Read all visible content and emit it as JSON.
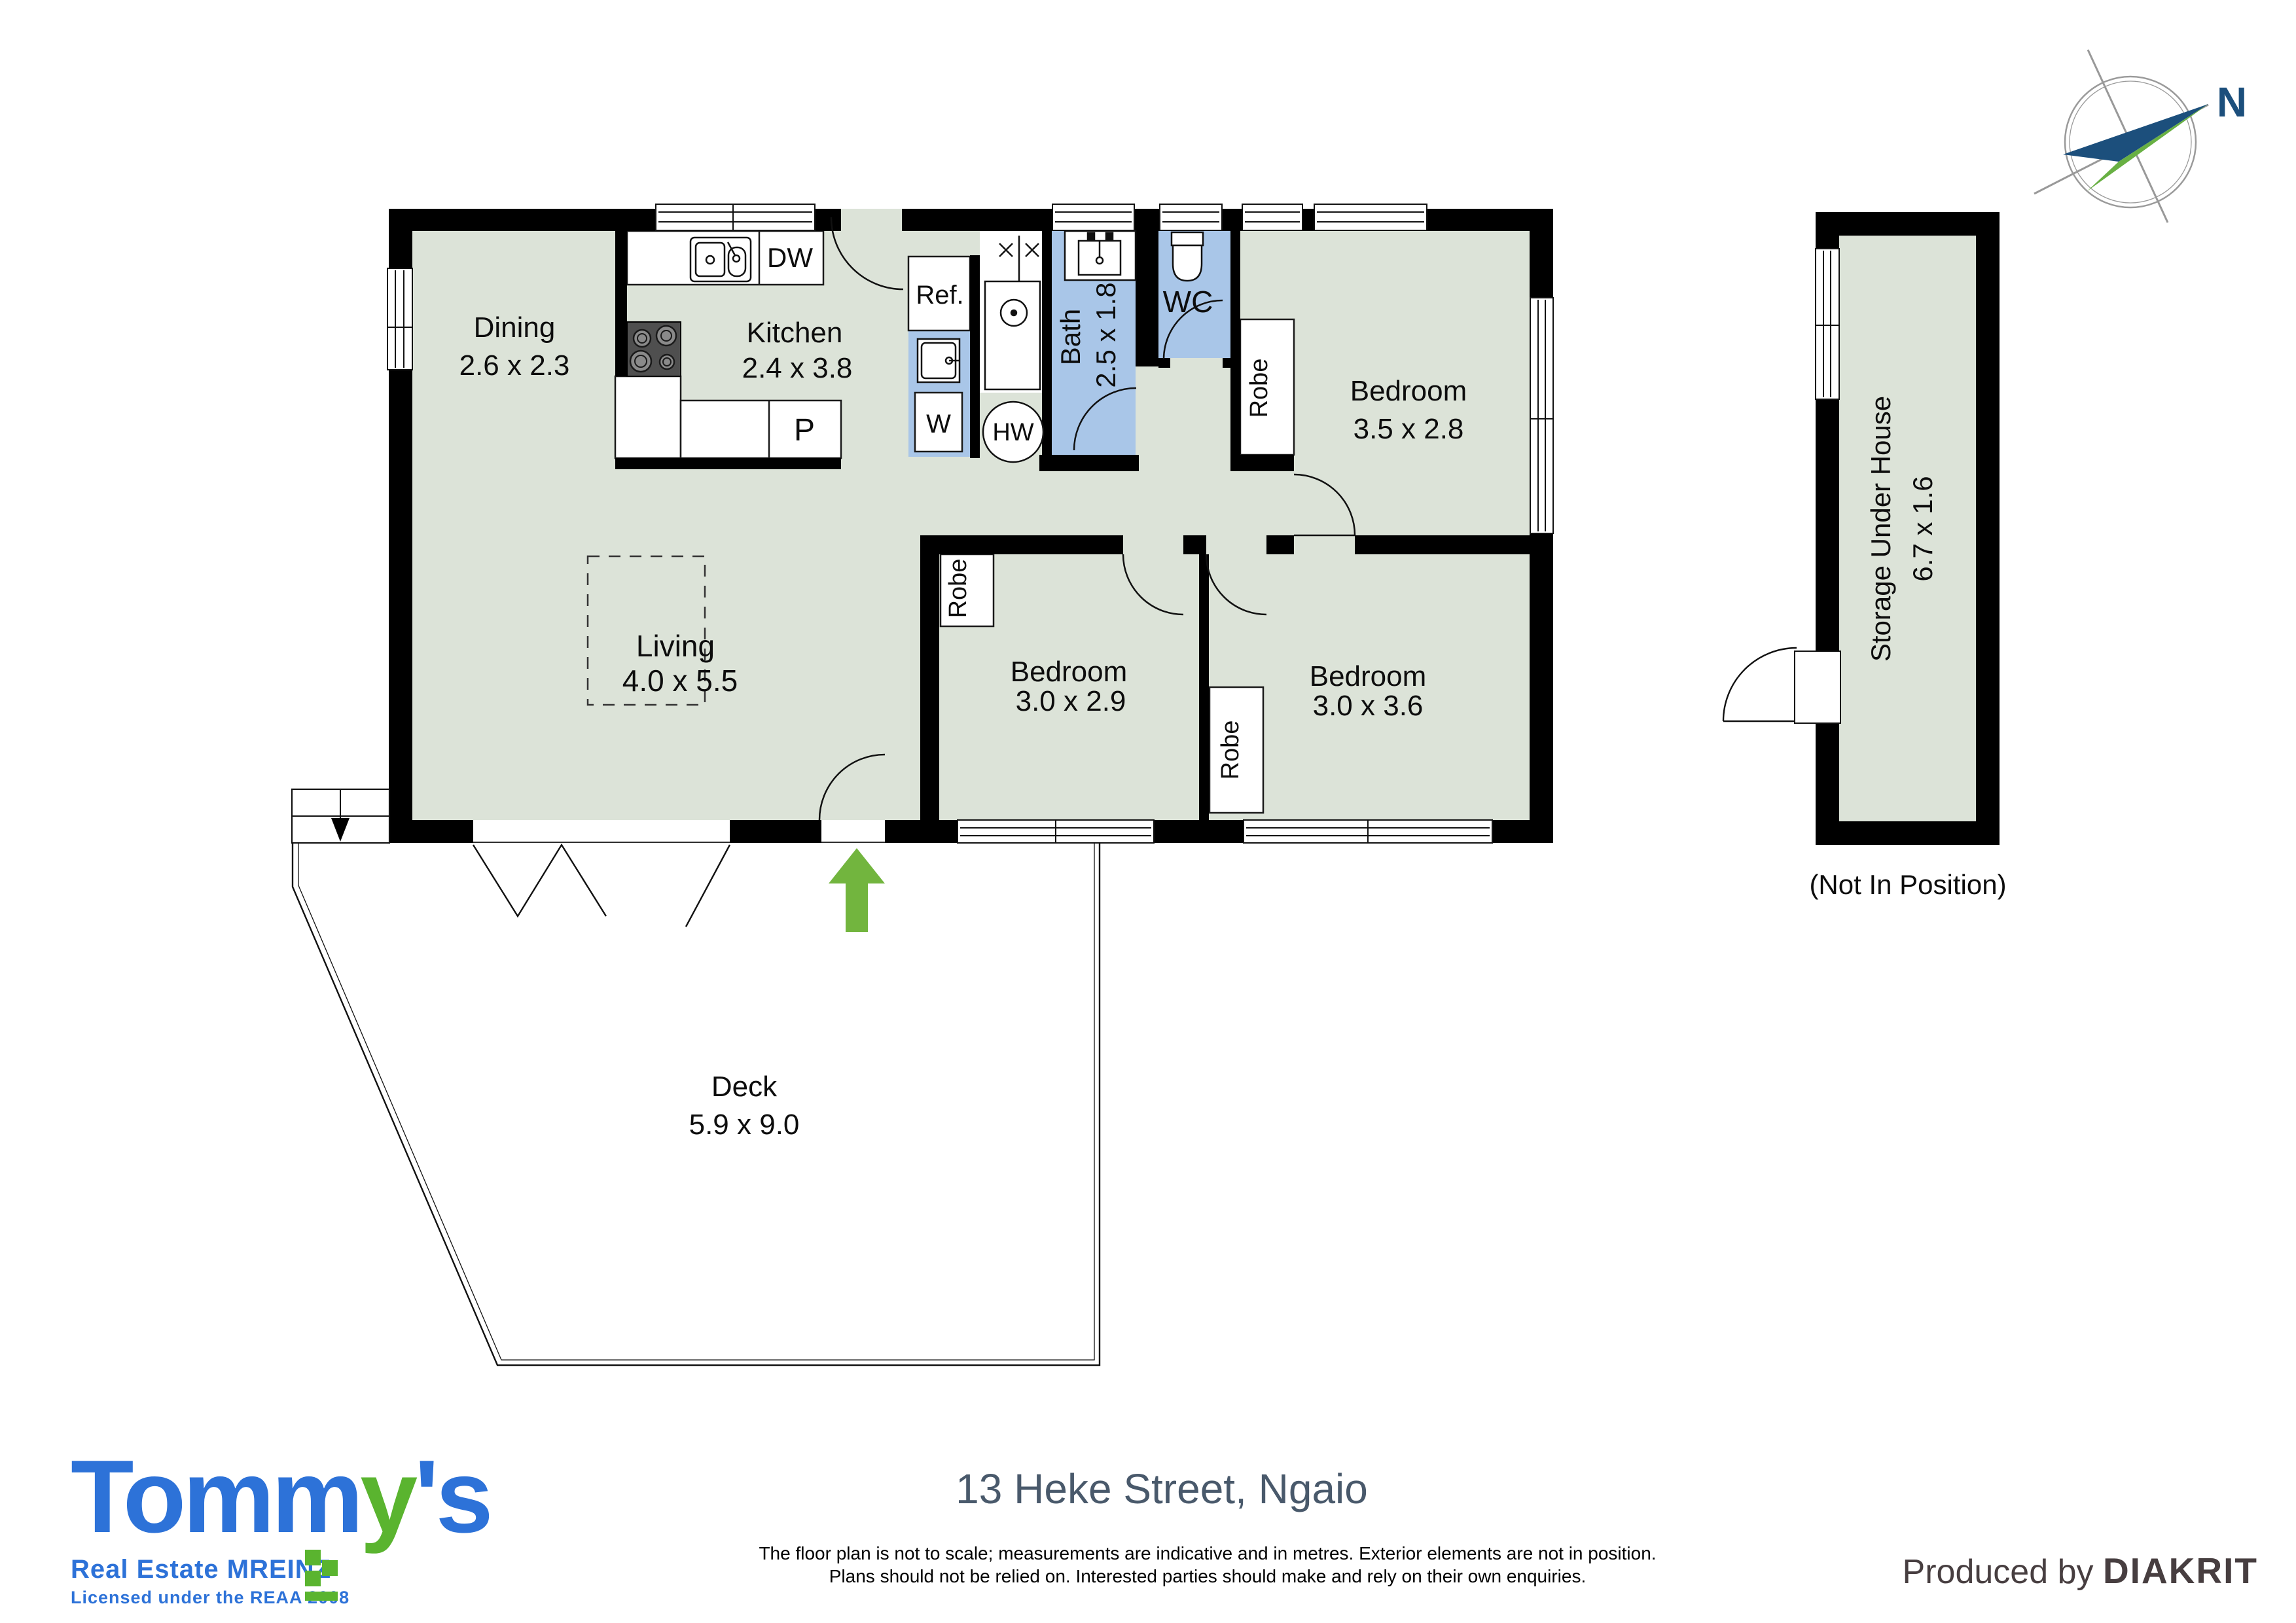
{
  "title": "13 Heke Street, Ngaio",
  "disclaimer": {
    "line1": "The floor plan is not to scale; measurements are indicative and in metres. Exterior elements are not in position.",
    "line2": "Plans should not be relied on. Interested parties should make and rely on their own enquiries."
  },
  "producer": {
    "prefix": "Produced by ",
    "name": "DIAKRIT"
  },
  "agency": {
    "name_blue1": "Tomm",
    "name_green": "y",
    "name_blue2": "'s",
    "tagline": "Real Estate MREINZ",
    "license": "Licensed under the REAA 2008",
    "blue": "#2d72d8",
    "green": "#5ab42f"
  },
  "compass": {
    "north_label": "N"
  },
  "floorplan": {
    "rooms": [
      {
        "name": "Dining",
        "dims": "2.6 x 2.3"
      },
      {
        "name": "Kitchen",
        "dims": "2.4 x 3.8"
      },
      {
        "name": "Bath",
        "dims": "2.5 x 1.8"
      },
      {
        "name": "WC"
      },
      {
        "name": "Bedroom",
        "dims": "3.5 x 2.8"
      },
      {
        "name": "Living",
        "dims": "4.0 x 5.5"
      },
      {
        "name": "Bedroom",
        "dims": "3.0 x 2.9"
      },
      {
        "name": "Bedroom",
        "dims": "3.0 x 3.6"
      },
      {
        "name": "Deck",
        "dims": "5.9 x 9.0"
      },
      {
        "name": "Storage Under House",
        "dims": "6.7 x 1.6"
      }
    ],
    "fixtures": {
      "dishwasher": "DW",
      "fridge": "Ref.",
      "pantry": "P",
      "washer": "W",
      "hot_water": "HW",
      "robe": "Robe"
    },
    "annotations": {
      "storage_note": "(Not In Position)"
    },
    "colors": {
      "floor": "#dce3d8",
      "wet_area": "#a9c6e8",
      "wall": "#000000",
      "entry_arrow": "#72b53e"
    }
  }
}
